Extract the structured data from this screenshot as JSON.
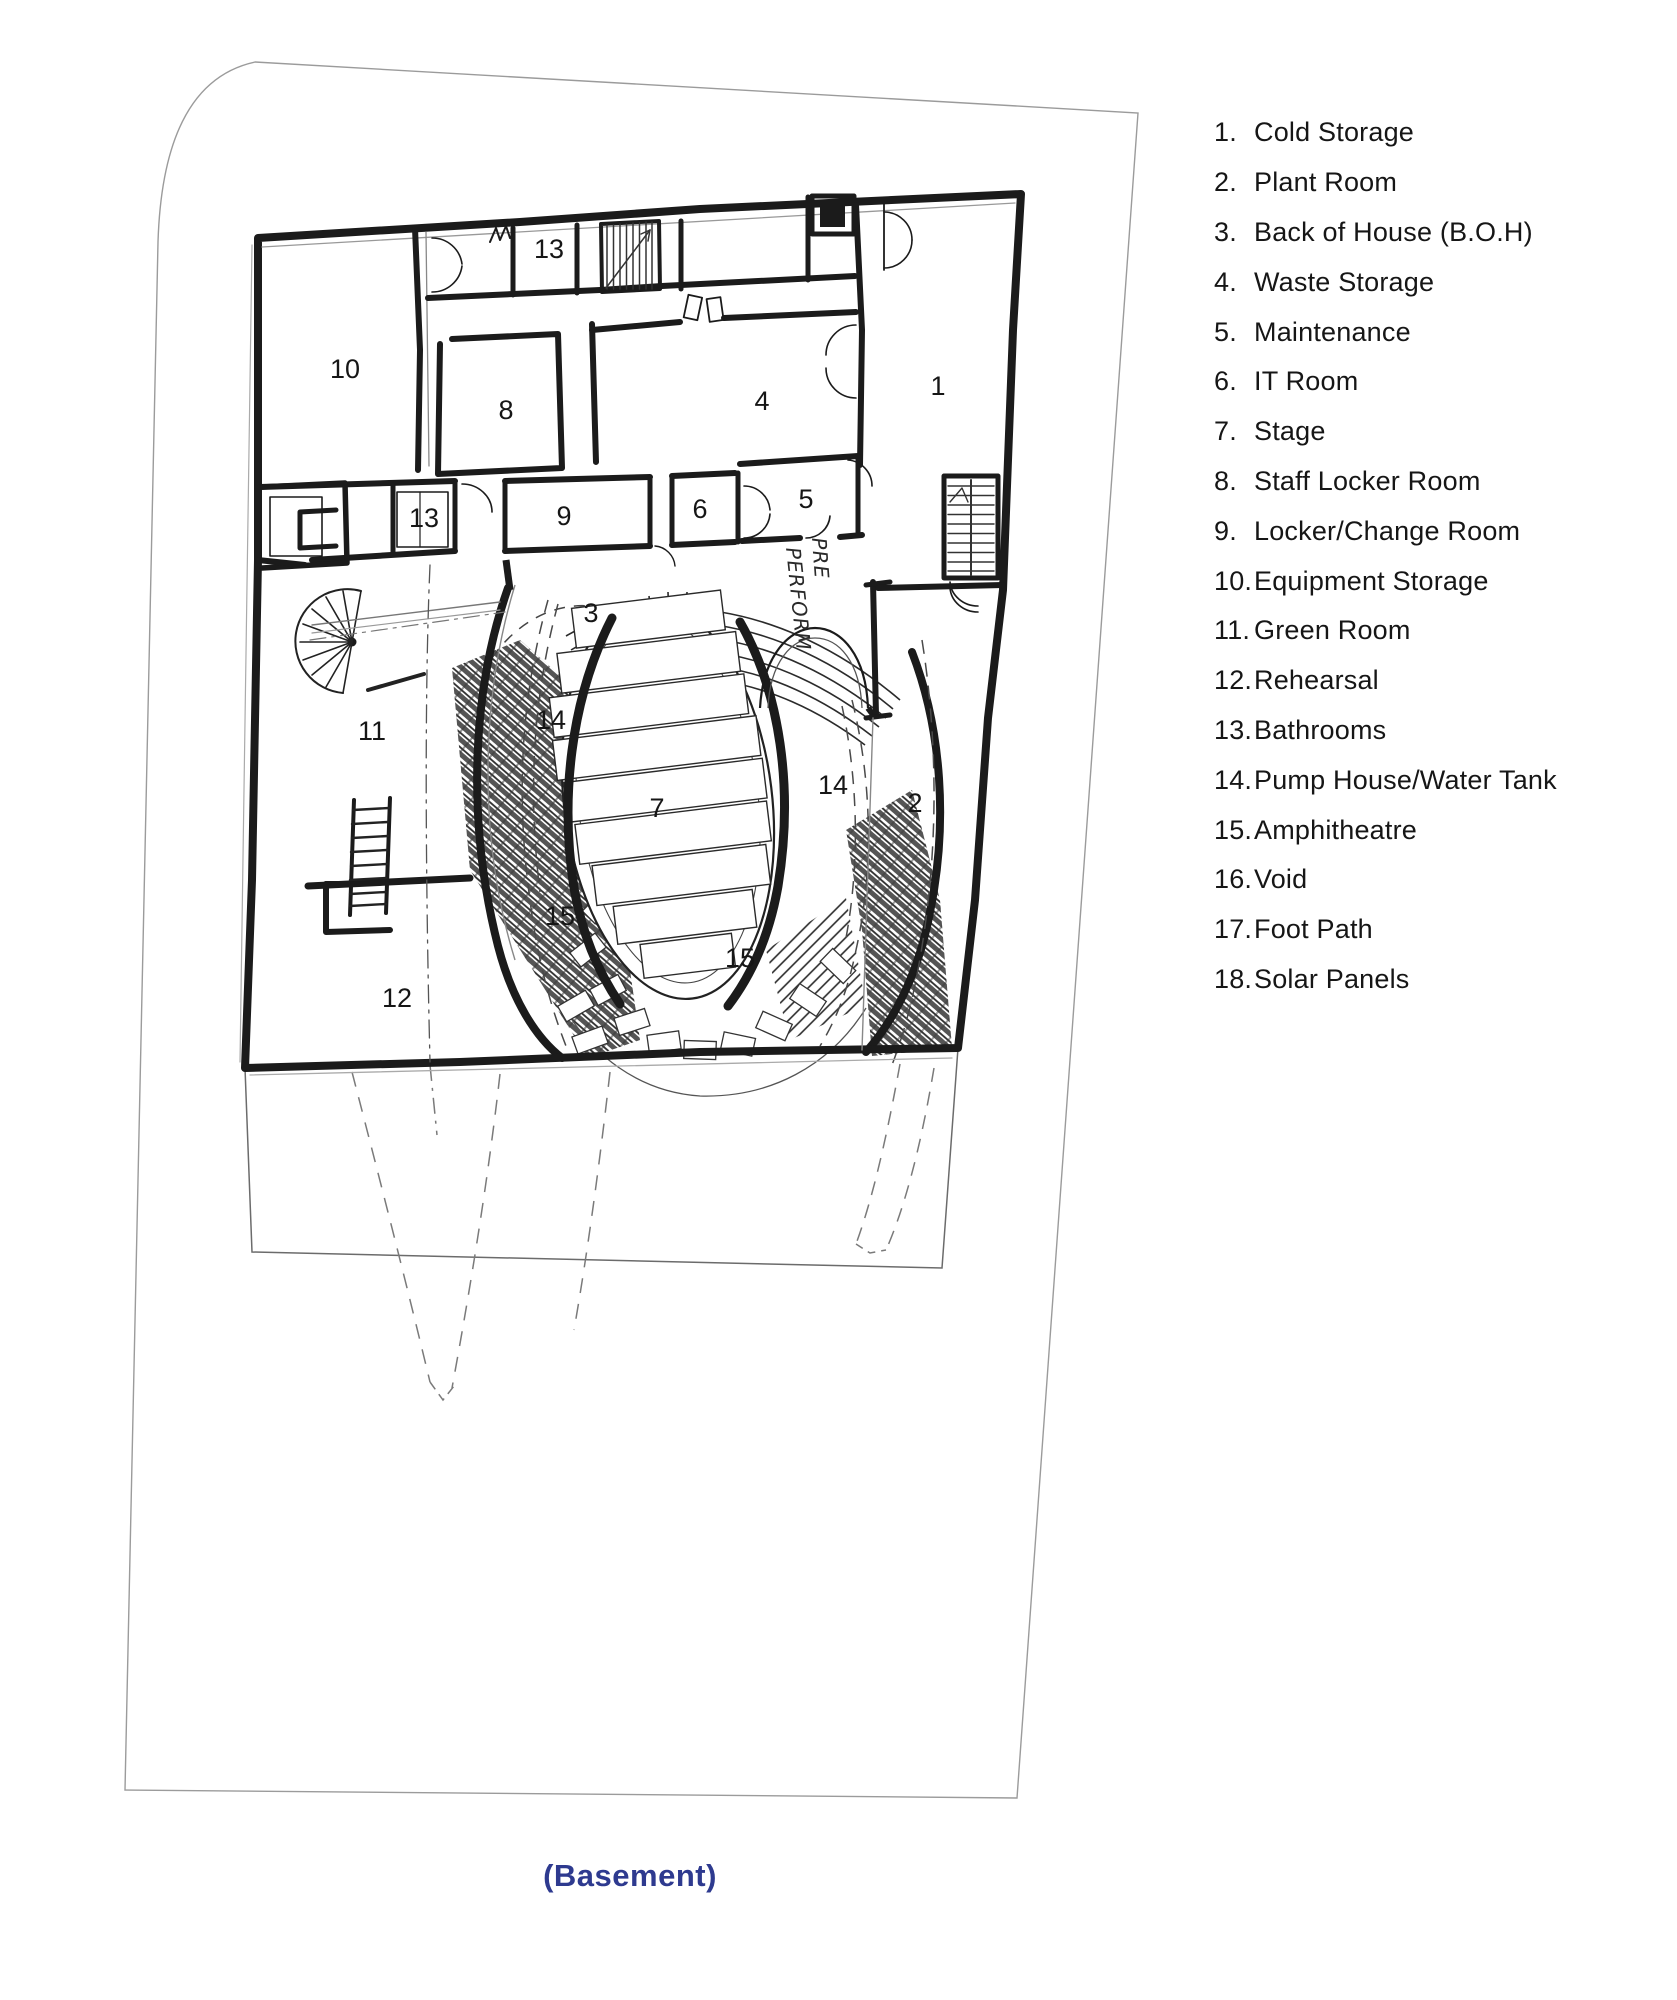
{
  "plan": {
    "numbers": {
      "r1": "1",
      "r2": "2",
      "r3": "3",
      "r4": "4",
      "r5": "5",
      "r6": "6",
      "r7": "7",
      "r8": "8",
      "r9": "9",
      "r10": "10",
      "r11": "11",
      "r12": "12",
      "r13a": "13",
      "r13b": "13",
      "r14a": "14",
      "r14b": "14",
      "r15a": "15",
      "r15b": "15"
    },
    "annotations": {
      "line1": "PRE",
      "line2": "PERFORM"
    }
  },
  "legend": {
    "items": [
      {
        "num": "1.",
        "label": "Cold Storage"
      },
      {
        "num": "2.",
        "label": "Plant Room"
      },
      {
        "num": "3.",
        "label": "Back of House (B.O.H)"
      },
      {
        "num": "4.",
        "label": "Waste Storage"
      },
      {
        "num": "5.",
        "label": "Maintenance"
      },
      {
        "num": "6.",
        "label": "IT Room"
      },
      {
        "num": "7.",
        "label": "Stage"
      },
      {
        "num": "8.",
        "label": "Staff Locker Room"
      },
      {
        "num": "9.",
        "label": "Locker/Change Room"
      },
      {
        "num": "10.",
        "label": "Equipment Storage"
      },
      {
        "num": "11.",
        "label": "Green Room"
      },
      {
        "num": "12.",
        "label": "Rehearsal"
      },
      {
        "num": "13.",
        "label": "Bathrooms"
      },
      {
        "num": "14.",
        "label": "Pump House/Water Tank"
      },
      {
        "num": "15.",
        "label": "Amphitheatre"
      },
      {
        "num": "16.",
        "label": "Void"
      },
      {
        "num": "17.",
        "label": "Foot Path"
      },
      {
        "num": "18.",
        "label": "Solar Panels"
      }
    ]
  },
  "caption": "(Basement)",
  "colors": {
    "caption_blue": "#2e3a8f",
    "ink": "#1b1b1b"
  }
}
